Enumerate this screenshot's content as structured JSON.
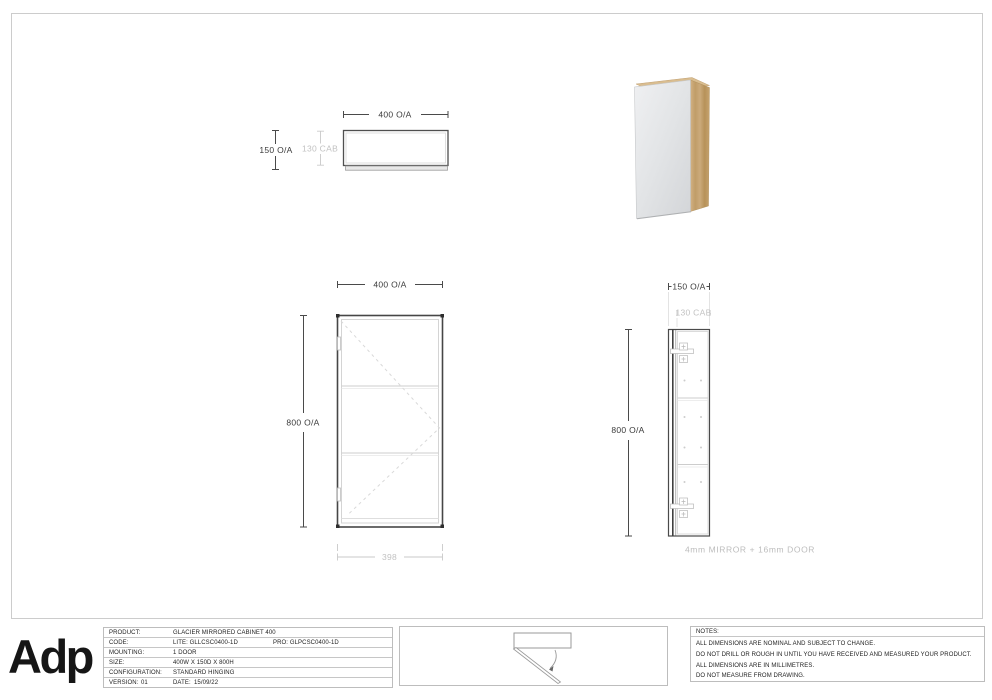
{
  "views": {
    "top_view": {
      "width_dim": "400 O/A",
      "depth_dim": "150 O/A",
      "cab_dim": "130 CAB"
    },
    "front_view": {
      "width_dim": "400 O/A",
      "height_dim": "800 O/A",
      "cutout_dim": "398"
    },
    "side_view": {
      "depth_dim": "150 O/A",
      "cab_dim": "130 CAB",
      "height_dim": "800 O/A",
      "construction_note": "4mm MIRROR + 16mm DOOR"
    }
  },
  "title_block": {
    "logo_text": "Adp",
    "table": {
      "rows": [
        {
          "label": "PRODUCT:",
          "value": "GLACIER MIRRORED CABINET 400"
        },
        {
          "label": "CODE:",
          "value": "LITE: GLLCSC0400-1D",
          "value2": "PRO: GLPCSC0400-1D"
        },
        {
          "label": "MOUNTING:",
          "value": "1 DOOR"
        },
        {
          "label": "SIZE:",
          "value": "400W X 150D X 800H"
        },
        {
          "label": "CONFIGURATION:",
          "value": "STANDARD HINGING"
        },
        {
          "label": "VERSION:",
          "value": "01",
          "label2": "DATE:",
          "value2": "15/09/22"
        }
      ]
    },
    "notes": {
      "heading": "NOTES:",
      "lines": [
        "ALL DIMENSIONS ARE NOMINAL AND SUBJECT TO CHANGE.",
        "DO NOT DRILL OR ROUGH IN UNTIL YOU HAVE RECEIVED AND MEASURED YOUR PRODUCT.",
        "ALL DIMENSIONS ARE IN MILLIMETRES.",
        "DO NOT MEASURE FROM DRAWING."
      ]
    }
  },
  "colors": {
    "line_dark": "#464646",
    "line_light": "#d4d4d4",
    "dim_gray": "#c2c2c2",
    "wood": "#c4a26f",
    "mirror": "#e3e5e7"
  }
}
